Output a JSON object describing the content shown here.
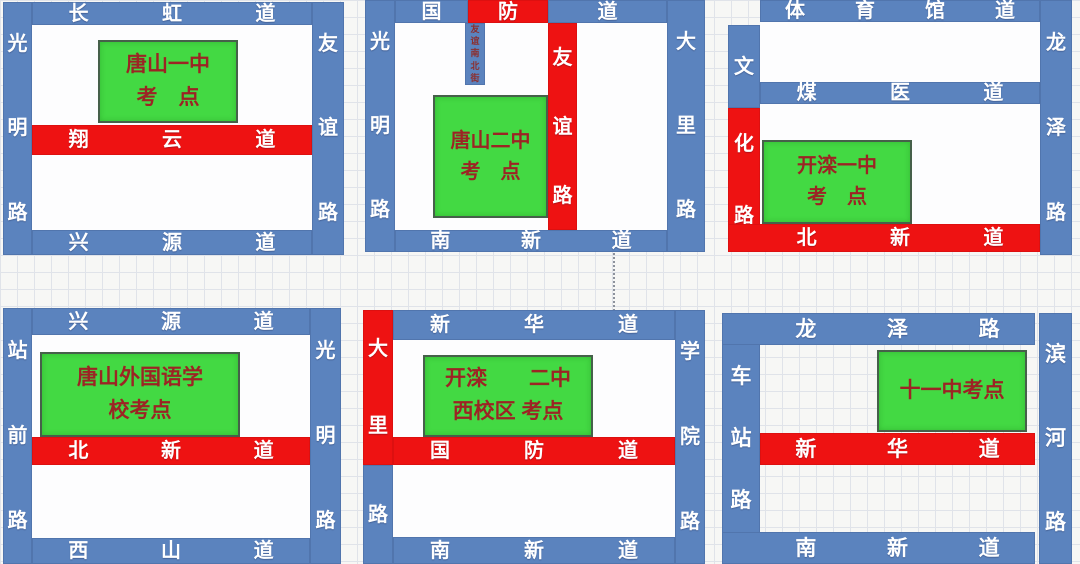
{
  "colors": {
    "road_blue": "#5b83be",
    "road_red": "#ee1212",
    "site_green": "#43d943",
    "site_text_red": "#9c2424",
    "road_text": "#ffffff",
    "grid_line": "#e0e3e9"
  },
  "panels": [
    {
      "key": "tangshan-no1",
      "site": {
        "line1": "唐山一中",
        "line2": "考　点"
      },
      "roads": {
        "top": "长虹道",
        "left": "光明路",
        "right": "友谊路",
        "mid_red": "翔云道",
        "bottom": "兴源道"
      }
    },
    {
      "key": "tangshan-no2",
      "site": {
        "line1": "唐山二中",
        "line2": "考　点"
      },
      "roads": {
        "top_left": "国",
        "top_mid": "防",
        "top_right": "道",
        "left": "光明路",
        "right": "大里路",
        "vertical_red": "友谊路",
        "alley": "友谊南北街",
        "bottom": "南新道"
      }
    },
    {
      "key": "kailuan-no1",
      "site": {
        "line1": "开滦一中",
        "line2": "考　点"
      },
      "roads": {
        "top": "体育馆道",
        "mid": "煤医道",
        "left_top": "文",
        "left_bottom_red": "化路",
        "right": "龙泽路",
        "bottom_red": "北新道"
      }
    },
    {
      "key": "tangshan-foreign-language-school",
      "site": {
        "line1": "唐山外国语学",
        "line2": "校考点"
      },
      "roads": {
        "top": "兴源道",
        "left": "站前路",
        "right": "光明路",
        "mid_red": "北新道",
        "bottom": "西山道"
      }
    },
    {
      "key": "kailuan-no2-west-campus",
      "site": {
        "line1": "开滦　　二中",
        "line2": "西校区 考点"
      },
      "roads": {
        "top": "新华道",
        "left_top_red": "大里",
        "left_bottom": "路",
        "right": "学院路",
        "mid_red": "国防道",
        "bottom": "南新道"
      }
    },
    {
      "key": "no11-middle-school",
      "site": {
        "line1": "十一中考点"
      },
      "roads": {
        "top": "龙泽路",
        "left": "车站路",
        "right": "滨河路",
        "mid_red": "新华道",
        "bottom": "南新道"
      }
    }
  ]
}
